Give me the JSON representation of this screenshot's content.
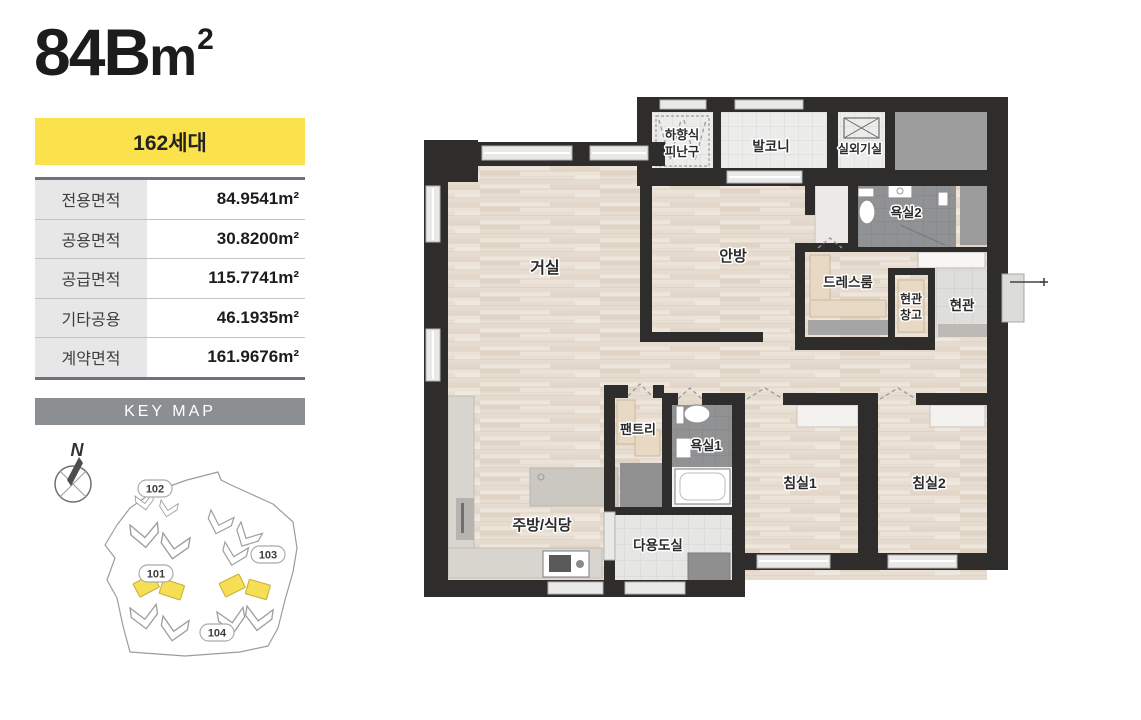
{
  "unit": {
    "area_code": "84B",
    "area_unit": "m",
    "area_sup": "2",
    "households": "162세대"
  },
  "info_table": {
    "rows": [
      {
        "label": "전용면적",
        "value": "84.9541m²"
      },
      {
        "label": "공용면적",
        "value": "30.8200m²"
      },
      {
        "label": "공급면적",
        "value": "115.7741m²"
      },
      {
        "label": "기타공용",
        "value": "46.1935m²"
      },
      {
        "label": "계약면적",
        "value": "161.9676m²"
      }
    ]
  },
  "key_map": {
    "title": "KEY MAP",
    "north_label": "N",
    "building_ids": {
      "b101": "101",
      "b102": "102",
      "b103": "103",
      "b104": "104"
    }
  },
  "floorplan": {
    "labels": {
      "hatch_line1": "하향식",
      "hatch_line2": "피난구",
      "balcony": "발코니",
      "outdoor_unit": "실외기실",
      "living": "거실",
      "master": "안방",
      "bath2": "욕실2",
      "dress": "드레스룸",
      "entry_storage_line1": "현관",
      "entry_storage_line2": "창고",
      "entrance": "현관",
      "pantry": "팬트리",
      "bath1": "욕실1",
      "kitchen": "주방/식당",
      "utility": "다용도실",
      "bed1": "침실1",
      "bed2": "침실2"
    }
  },
  "colors": {
    "badge_yellow": "#fbe14c",
    "keymap_bar_gray": "#8b8f92",
    "wall_dark": "#2f2d2b",
    "wood_floor": "#e9e0d6",
    "highlight_building_yellow": "#f6df55"
  }
}
